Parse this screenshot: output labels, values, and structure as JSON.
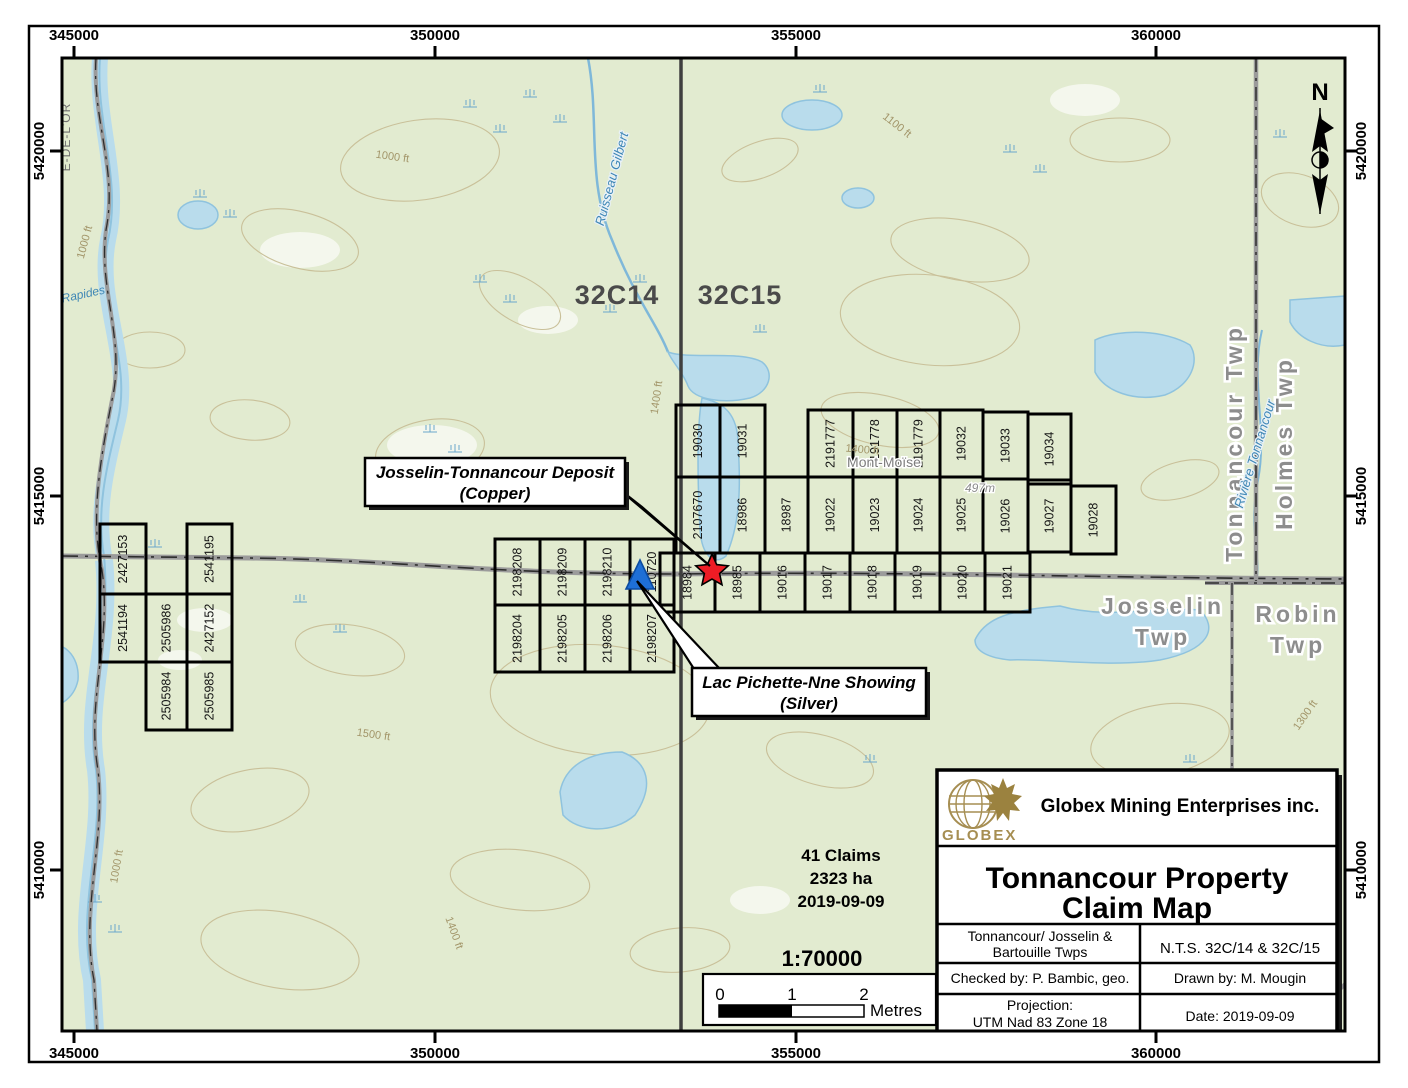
{
  "frame": {
    "coords_top": [
      "345000",
      "350000",
      "355000",
      "360000"
    ],
    "coords_bottom": [
      "345000",
      "350000",
      "355000",
      "360000"
    ],
    "coords_left": [
      "5420000",
      "5415000",
      "5410000"
    ],
    "coords_right": [
      "5420000",
      "5415000",
      "5410000"
    ]
  },
  "compass": {
    "label": "N"
  },
  "stats": {
    "claims": "41 Claims",
    "area": "2323 ha",
    "date": "2019-09-09"
  },
  "scale": {
    "ratio": "1:70000",
    "tick0": "0",
    "tick1": "1",
    "tick2": "2",
    "unit": "Metres"
  },
  "callouts": {
    "deposit": {
      "line1": "Josselin-Tonnancour Deposit",
      "line2": "(Copper)"
    },
    "showing": {
      "line1": "Lac Pichette-Nne Showing",
      "line2": "(Silver)"
    }
  },
  "title_block": {
    "logo_text": "GLOBEX",
    "company": "Globex Mining Enterprises inc.",
    "title_line1": "Tonnancour Property",
    "title_line2": "Claim Map",
    "area_line1": "Tonnancour/ Josselin &",
    "area_line2": "Bartouille Twps",
    "nts_ref": "N.T.S. 32C/14 & 32C/15",
    "checked_by": "Checked by: P. Bambic, geo.",
    "drawn_by": "Drawn by: M. Mougin",
    "projection_line1": "Projection:",
    "projection_line2": "UTM Nad 83 Zone 18",
    "date": "Date: 2019-09-09"
  },
  "claims": {
    "groups": [
      {
        "id": "west-group",
        "cells": [
          {
            "number": "2427153",
            "x": 100,
            "y": 524,
            "w": 46,
            "h": 70
          },
          {
            "number": "2541195",
            "x": 187,
            "y": 524,
            "w": 45,
            "h": 70
          },
          {
            "number": "2541194",
            "x": 100,
            "y": 594,
            "w": 46,
            "h": 68
          },
          {
            "number": "2505986",
            "x": 146,
            "y": 594,
            "w": 41,
            "h": 68
          },
          {
            "number": "2427152",
            "x": 187,
            "y": 594,
            "w": 45,
            "h": 68
          },
          {
            "number": "2505984",
            "x": 146,
            "y": 662,
            "w": 41,
            "h": 68
          },
          {
            "number": "2505985",
            "x": 187,
            "y": 662,
            "w": 45,
            "h": 68
          }
        ]
      },
      {
        "id": "central-group",
        "cells": [
          {
            "number": "2198208",
            "x": 495,
            "y": 539,
            "w": 45,
            "h": 66
          },
          {
            "number": "2198209",
            "x": 540,
            "y": 539,
            "w": 45,
            "h": 66
          },
          {
            "number": "2198210",
            "x": 585,
            "y": 539,
            "w": 45,
            "h": 66
          },
          {
            "number": "110720",
            "x": 630,
            "y": 539,
            "w": 44,
            "h": 66
          },
          {
            "number": "2198204",
            "x": 495,
            "y": 605,
            "w": 45,
            "h": 67
          },
          {
            "number": "2198205",
            "x": 540,
            "y": 605,
            "w": 45,
            "h": 67
          },
          {
            "number": "2198206",
            "x": 585,
            "y": 605,
            "w": 45,
            "h": 67
          },
          {
            "number": "2198207",
            "x": 630,
            "y": 605,
            "w": 44,
            "h": 67
          }
        ]
      },
      {
        "id": "east-group",
        "cells": [
          {
            "number": "19030",
            "x": 676,
            "y": 405,
            "w": 44,
            "h": 72
          },
          {
            "number": "19031",
            "x": 720,
            "y": 405,
            "w": 45,
            "h": 72
          },
          {
            "number": "2191777",
            "x": 808,
            "y": 410,
            "w": 45,
            "h": 67
          },
          {
            "number": "2191778",
            "x": 853,
            "y": 410,
            "w": 44,
            "h": 67
          },
          {
            "number": "2191779",
            "x": 897,
            "y": 410,
            "w": 43,
            "h": 67
          },
          {
            "number": "19032",
            "x": 940,
            "y": 410,
            "w": 43,
            "h": 67
          },
          {
            "number": "19033",
            "x": 983,
            "y": 412,
            "w": 45,
            "h": 67
          },
          {
            "number": "19034",
            "x": 1028,
            "y": 414,
            "w": 43,
            "h": 70
          },
          {
            "number": "2107670",
            "x": 676,
            "y": 477,
            "w": 44,
            "h": 76
          },
          {
            "number": "18986",
            "x": 720,
            "y": 477,
            "w": 45,
            "h": 76
          },
          {
            "number": "18987",
            "x": 765,
            "y": 477,
            "w": 43,
            "h": 76
          },
          {
            "number": "19022",
            "x": 808,
            "y": 477,
            "w": 45,
            "h": 76
          },
          {
            "number": "19023",
            "x": 853,
            "y": 477,
            "w": 44,
            "h": 76
          },
          {
            "number": "19024",
            "x": 897,
            "y": 477,
            "w": 43,
            "h": 76
          },
          {
            "number": "19025",
            "x": 940,
            "y": 477,
            "w": 43,
            "h": 76
          },
          {
            "number": "19026",
            "x": 983,
            "y": 479,
            "w": 45,
            "h": 74
          },
          {
            "number": "19027",
            "x": 1028,
            "y": 480,
            "w": 43,
            "h": 72
          },
          {
            "number": "19028",
            "x": 1071,
            "y": 486,
            "w": 45,
            "h": 68
          },
          {
            "number": "18984",
            "x": 660,
            "y": 553,
            "w": 55,
            "h": 59
          },
          {
            "number": "18985",
            "x": 715,
            "y": 553,
            "w": 45,
            "h": 59
          },
          {
            "number": "19016",
            "x": 760,
            "y": 553,
            "w": 45,
            "h": 59
          },
          {
            "number": "19017",
            "x": 805,
            "y": 553,
            "w": 45,
            "h": 59
          },
          {
            "number": "19018",
            "x": 850,
            "y": 553,
            "w": 45,
            "h": 59
          },
          {
            "number": "19019",
            "x": 895,
            "y": 553,
            "w": 45,
            "h": 59
          },
          {
            "number": "19020",
            "x": 940,
            "y": 553,
            "w": 45,
            "h": 59
          },
          {
            "number": "19021",
            "x": 985,
            "y": 553,
            "w": 45,
            "h": 59
          }
        ]
      }
    ]
  },
  "place_labels": [
    {
      "text": "32C14",
      "x": 617,
      "y": 304,
      "rot": 0,
      "cls": "nts-label"
    },
    {
      "text": "32C15",
      "x": 740,
      "y": 304,
      "rot": 0,
      "cls": "nts-label"
    },
    {
      "text": "Josselin",
      "x": 1163,
      "y": 614,
      "rot": 0,
      "cls": "twp-big"
    },
    {
      "text": "Twp",
      "x": 1163,
      "y": 645,
      "rot": 0,
      "cls": "twp-big"
    },
    {
      "text": "Robin",
      "x": 1298,
      "y": 622,
      "rot": 0,
      "cls": "twp-big"
    },
    {
      "text": "Twp",
      "x": 1298,
      "y": 653,
      "rot": 0,
      "cls": "twp-big"
    },
    {
      "text": "Tonnancour Twp",
      "x": 1242,
      "y": 443,
      "rot": -90,
      "cls": "twp-big"
    },
    {
      "text": "Holmes Twp",
      "x": 1292,
      "y": 443,
      "rot": -90,
      "cls": "twp-big"
    },
    {
      "text": "Mont-Moïse",
      "x": 884,
      "y": 467,
      "rot": 0,
      "cls": "place-small"
    },
    {
      "text": "497m",
      "x": 980,
      "y": 492,
      "rot": 0,
      "cls": "place-tiny"
    },
    {
      "text": "Ruisseau Gilbert",
      "x": 616,
      "y": 180,
      "rot": -75,
      "cls": "water-name"
    },
    {
      "text": "Rivière Tonnancour",
      "x": 1259,
      "y": 455,
      "rot": -73,
      "cls": "water-name"
    },
    {
      "text": "Rapides",
      "x": 84,
      "y": 298,
      "rot": -12,
      "cls": "water-name-sm"
    },
    {
      "text": "E-DE-L'OR",
      "x": 70,
      "y": 137,
      "rot": -90,
      "cls": "mrc-label"
    },
    {
      "text": "1000 ft",
      "x": 392,
      "y": 160,
      "rot": 8,
      "cls": "contour-label"
    },
    {
      "text": "1100 ft",
      "x": 895,
      "y": 128,
      "rot": 38,
      "cls": "contour-label"
    },
    {
      "text": "1400 ft",
      "x": 660,
      "y": 398,
      "rot": -82,
      "cls": "contour-label"
    },
    {
      "text": "1400 ft",
      "x": 862,
      "y": 453,
      "rot": 5,
      "cls": "contour-label"
    },
    {
      "text": "1000 ft",
      "x": 88,
      "y": 243,
      "rot": -75,
      "cls": "contour-label"
    },
    {
      "text": "1500 ft",
      "x": 373,
      "y": 738,
      "rot": 8,
      "cls": "contour-label"
    },
    {
      "text": "1300 ft",
      "x": 1308,
      "y": 717,
      "rot": -55,
      "cls": "contour-label"
    },
    {
      "text": "1400 ft",
      "x": 451,
      "y": 934,
      "rot": 70,
      "cls": "contour-label"
    },
    {
      "text": "1000 ft",
      "x": 120,
      "y": 867,
      "rot": -80,
      "cls": "contour-label"
    }
  ],
  "map_colors": {
    "land": "#e2ebd0",
    "water_fill": "#b9dcec",
    "water_line": "#7fb8d9",
    "contour": "#c9c099",
    "road": "#9b9b9b",
    "claim_line": "#000000",
    "star_red": "#ee1c25",
    "triangle_blue": "#1e6fd6",
    "globex_gold": "#a68e52"
  }
}
